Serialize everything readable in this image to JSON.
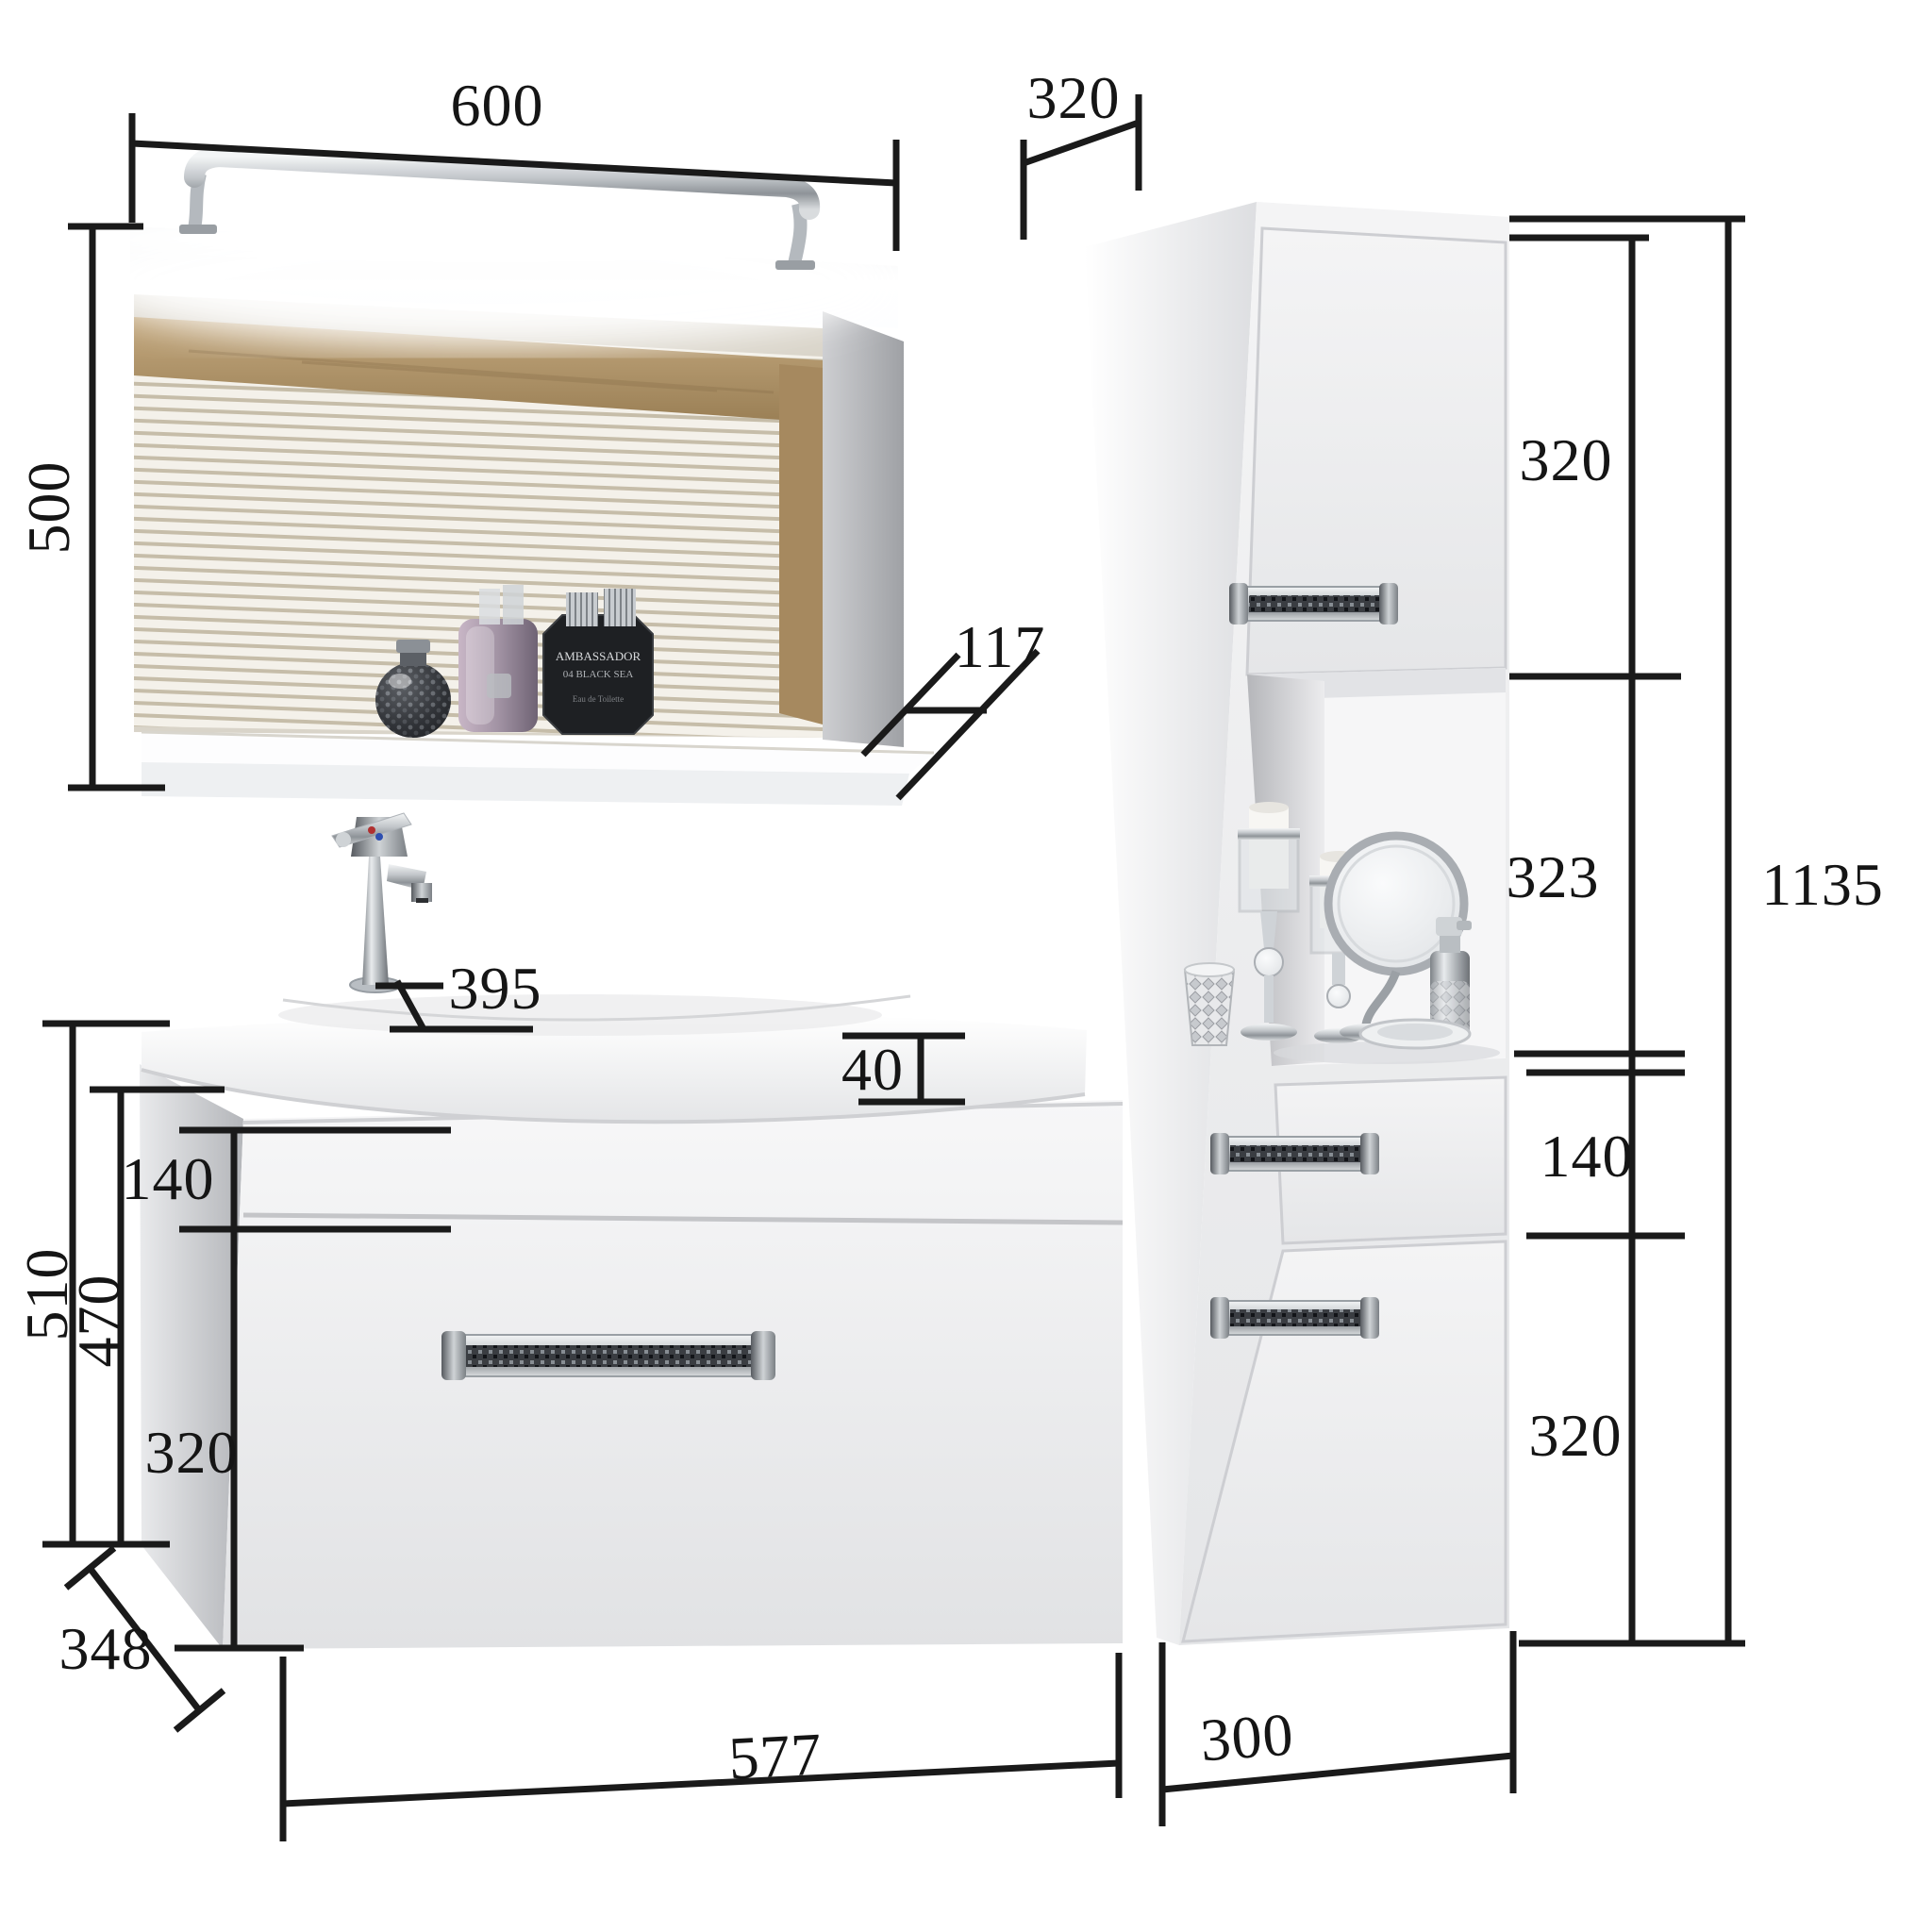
{
  "dims": {
    "mirror_width": "600",
    "mirror_height": "500",
    "cabinet_depth": "320",
    "shelf_depth": "117",
    "cabinet_top_door": "320",
    "cabinet_niche": "323",
    "cabinet_total_height": "1135",
    "basin_depth": "395",
    "basin_thickness": "40",
    "vanity_top_drawer": "140",
    "vanity_body_height": "470",
    "vanity_total_height": "510",
    "vanity_bottom_drawer": "320",
    "vanity_depth": "348",
    "vanity_width": "577",
    "cabinet_drawer": "140",
    "cabinet_bottom_door": "320",
    "cabinet_width": "300"
  },
  "decor": {
    "perfume_brand": "AMBASSADOR",
    "perfume_sub": "04 BLACK SEA",
    "perfume_small": "Eau de Toilette"
  }
}
